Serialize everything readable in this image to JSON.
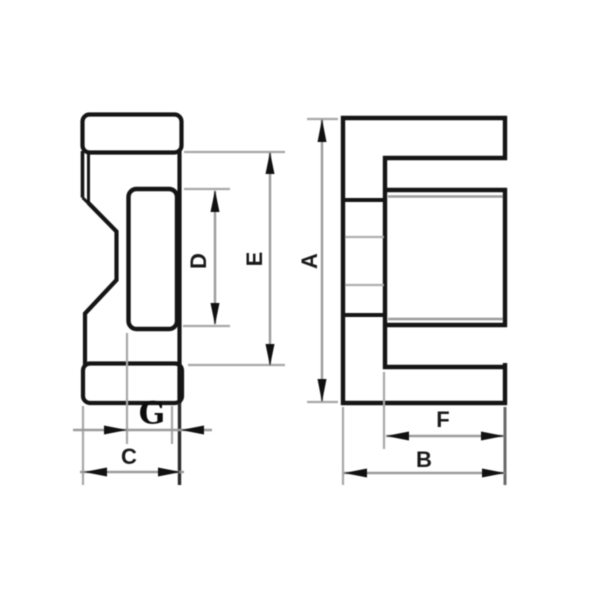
{
  "drawing": {
    "dimension_labels": {
      "A": "A",
      "B": "B",
      "C": "C",
      "D": "D",
      "E": "E",
      "F": "F",
      "G": "G"
    }
  },
  "colors": {
    "outline": "#151515",
    "dimension_line": "#9b9b9b",
    "extension_line": "#a8a8a8",
    "hidden_line": "#b0b0b0",
    "arrow": "#111111",
    "background": "#ffffff",
    "label": "#1a1a1a"
  }
}
